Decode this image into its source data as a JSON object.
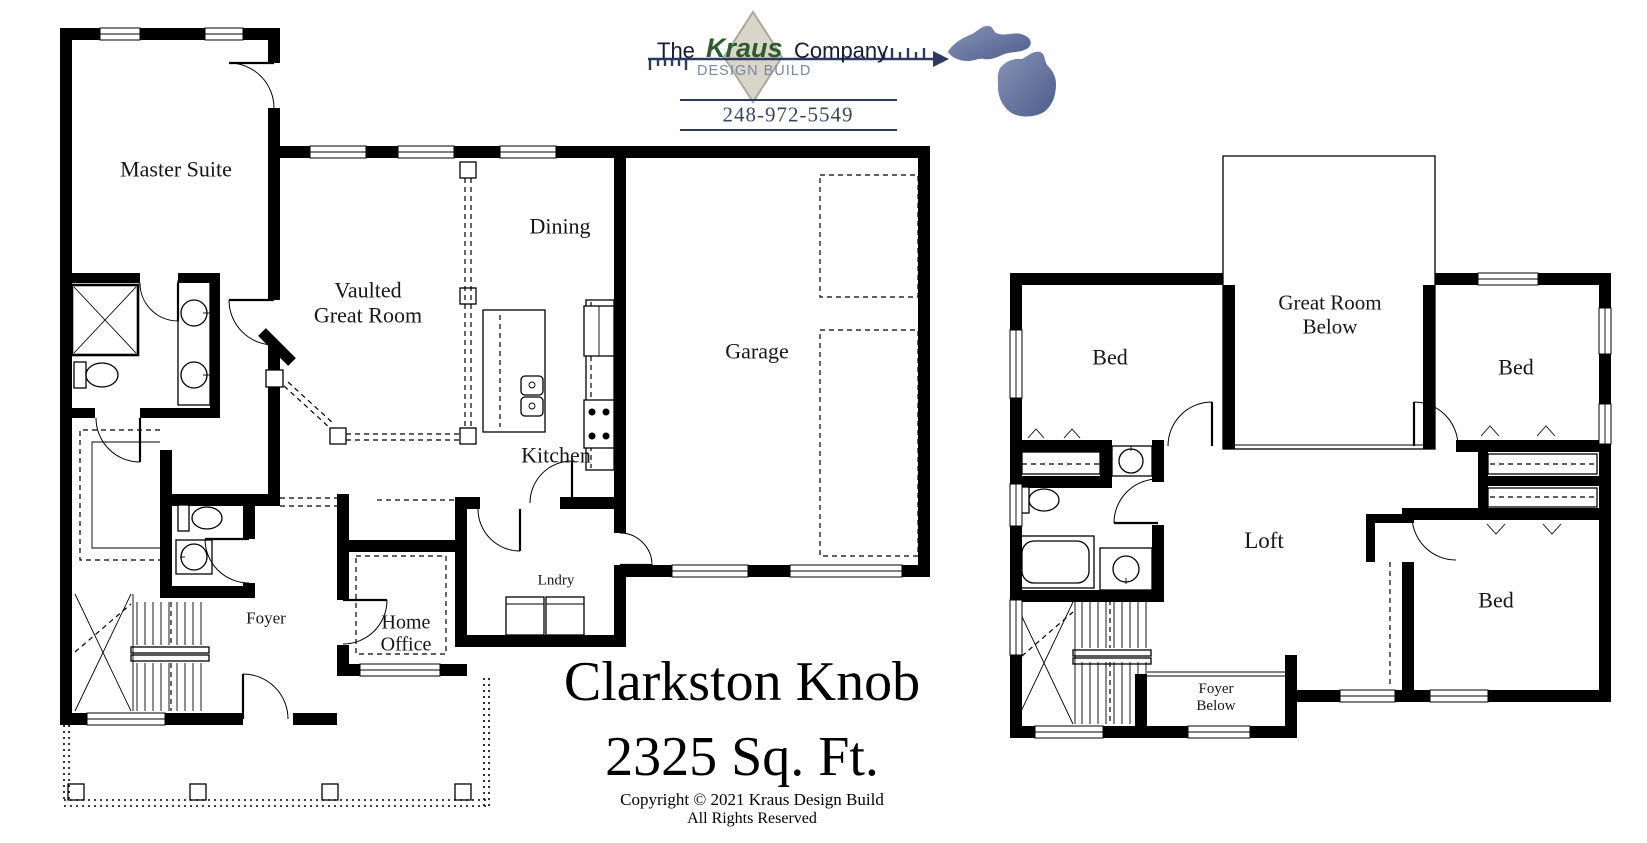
{
  "logo": {
    "the": "The",
    "kraus": "Kraus",
    "company": "Company",
    "tagline": "DESIGN BUILD",
    "phone": "248-972-5549",
    "colors": {
      "kraus_green": "#2e5b2e",
      "navy_text": "#141c38",
      "ruler_blue": "#2c3a60",
      "tagline_gray": "#7b86a0",
      "diamond_fill": "#d9d5c9",
      "diamond_border": "#a8a89e",
      "michigan_blue": "#5a6a99"
    }
  },
  "floor1": {
    "master_suite": "Master Suite",
    "great_room": "Vaulted\nGreat Room",
    "dining": "Dining",
    "kitchen": "Kitchen",
    "garage": "Garage",
    "foyer": "Foyer",
    "home_office": "Home\nOffice",
    "laundry": "Lndry"
  },
  "floor2": {
    "bed_left": "Bed",
    "great_room_below": "Great Room\nBelow",
    "bed_top_right": "Bed",
    "loft": "Loft",
    "bed_bottom_right": "Bed",
    "foyer_below": "Foyer\nBelow"
  },
  "title": {
    "name": "Clarkston Knob",
    "area": "2325 Sq. Ft."
  },
  "footer": {
    "copyright": "Copyright © 2021 Kraus Design Build",
    "rights": "All Rights Reserved"
  }
}
